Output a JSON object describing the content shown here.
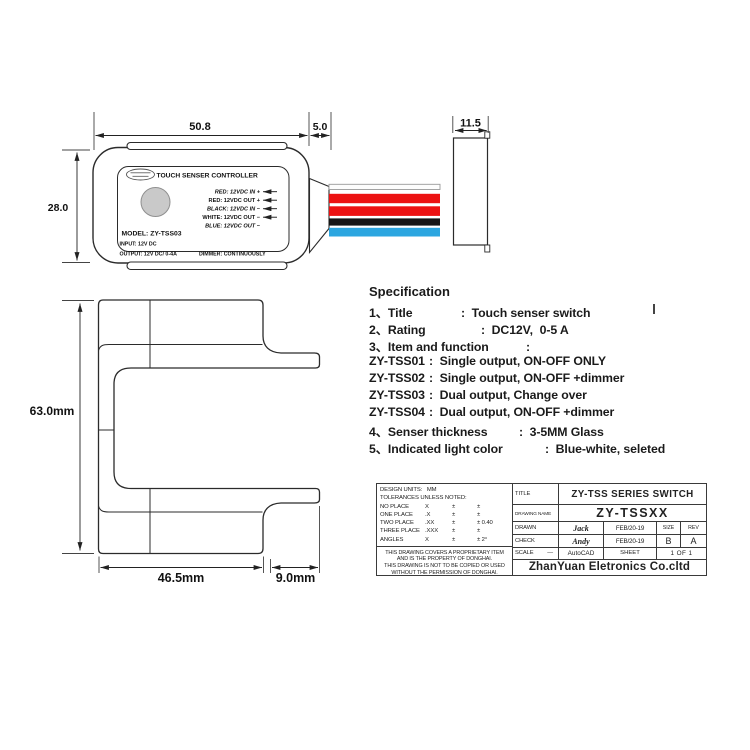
{
  "front_view": {
    "plate_title": "TOUCH SENSER CONTROLLER",
    "wire_labels": [
      "RED: 12VDC IN + ",
      "RED: 12VDC OUT + ",
      "BLACK: 12VDC IN − ",
      "WHITE: 12VDC OUT − ",
      "BLUE: 12VDC OUT −"
    ],
    "model_line": "MODEL: ZY-TSS03",
    "input_line": "INPUT: 12V DC",
    "output_line": "OUTPUT: 12V DC/ 0-4A",
    "dimmer_line": "DIMMER: CONTINUOUSLY",
    "wire_colors": {
      "white": "#fdfdfd",
      "red": "#ec1212",
      "black": "#151515",
      "blue": "#2ca6e0"
    },
    "touch_pad_color": "#c9c9c9"
  },
  "dimensions": {
    "body_width": "50.8",
    "connector_length": "5.0",
    "side_depth": "11.5",
    "body_height": "28.0",
    "profile_height": "63.0mm",
    "profile_width": "46.5mm",
    "arm_overhang": "9.0mm"
  },
  "specification": {
    "heading": "Specification",
    "rows": [
      {
        "label": "1、Title",
        "value": ":  Touch senser switch"
      },
      {
        "label": "2、Rating",
        "value": ":  DC12V,  0-5 A"
      },
      {
        "label": "3、Item and function",
        "value": ":"
      },
      {
        "label": "ZY-TSS01",
        "value": ":  Single output, ON-OFF ONLY"
      },
      {
        "label": "ZY-TSS02",
        "value": ":  Single output, ON-OFF +dimmer"
      },
      {
        "label": "ZY-TSS03",
        "value": ":  Dual output, Change over"
      },
      {
        "label": "ZY-TSS04",
        "value": ":  Dual output, ON-OFF +dimmer"
      },
      {
        "label": "4、Senser thickness",
        "value": ":  3-5MM Glass"
      },
      {
        "label": "5、Indicated light color",
        "value": ":  Blue-white, seleted"
      }
    ]
  },
  "title_block": {
    "design_units": "DESIGN UNITS:   MM",
    "tolerances_heading": "TOLERANCES UNLESS NOTED:",
    "tolerances": [
      {
        "place": "NO PLACE",
        "format": "X",
        "pm": "±",
        "tol": "±"
      },
      {
        "place": "ONE PLACE",
        "format": ".X",
        "pm": "±",
        "tol": "±"
      },
      {
        "place": "TWO PLACE",
        "format": ".XX",
        "pm": "±",
        "tol": "± 0.40"
      },
      {
        "place": "THREE PLACE",
        "format": ".XXX",
        "pm": "±",
        "tol": "±"
      },
      {
        "place": "ANGLES",
        "format": "X",
        "pm": "±",
        "tol": "± 2°"
      }
    ],
    "note_lines": [
      "THIS DRAWING COVERS A PROPRIETARY ITEM",
      "AND IS THE PROPERTY OF DONGHAI.",
      "THIS DRAWING IS NOT TO BE COPIED OR USED",
      "WITHOUT THE PERMISSION OF DONGHAI."
    ],
    "title_label": "TITLE",
    "title_value": "ZY-TSS SERIES SWITCH",
    "drawing_name_label": "DRAWING NAME",
    "drawing_name_value": "ZY-TSSXX",
    "drawn_label": "DRAWN",
    "drawn_by": "Jack",
    "drawn_date": "FEB/20-19",
    "size_label": "SIZE",
    "rev_label": "REV",
    "check_label": "CHECK",
    "checked_by": "Andy",
    "check_date": "FEB/20-19",
    "size_value": "B",
    "rev_value": "A",
    "scale_label": "SCALE",
    "scale_value": "—",
    "cad_tool": "AutoCAD",
    "sheet_label": "SHEET",
    "sheet_value": "1 OF 1",
    "company": "ZhanYuan Eletronics Co.cltd"
  }
}
